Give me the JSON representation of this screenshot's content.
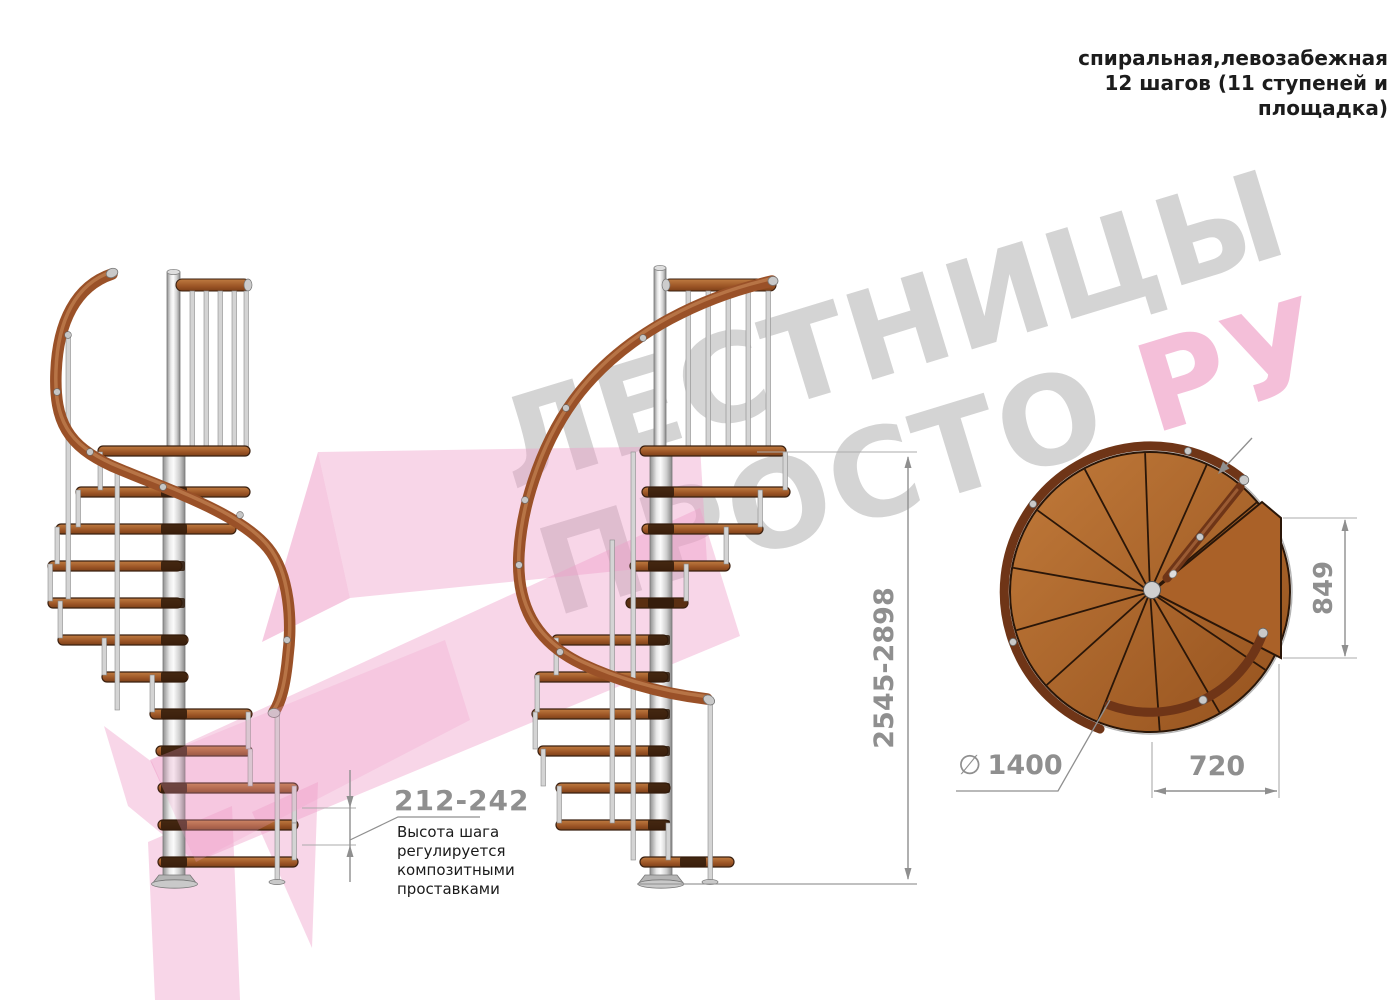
{
  "header": {
    "title": "спиральная,левозабежная\n12 шагов (11 ступеней и\nплощадка)"
  },
  "watermark": {
    "line1": "ЛЕСТНИЦЫ",
    "line2_gray": "ПРОСТО",
    "line2_pink": "РУ",
    "gray_color": "#d4d4d4",
    "pink_color": "#f0a6cb"
  },
  "dimensions": {
    "total_height": "2545-2898",
    "step_height": "212-242",
    "step_height_note": "Высота шага\nрегулируется\nкомпозитными\nпроставками",
    "landing_width": "849",
    "landing_offset": "720",
    "diameter_symbol": "∅",
    "diameter_value": "1400"
  },
  "drawing": {
    "views": [
      "боковой вид 1",
      "боковой вид 2",
      "вид сверху"
    ],
    "steps_per_revolution": 12,
    "treads_count": 11
  },
  "colors": {
    "wood": "#b06a2e",
    "handrail": "#9a5128",
    "plan_rail": "#6f3517",
    "pole": "#d9d9d9",
    "dimension_gray": "#8f8f8f",
    "pink_accent": "#ef9ec8"
  }
}
